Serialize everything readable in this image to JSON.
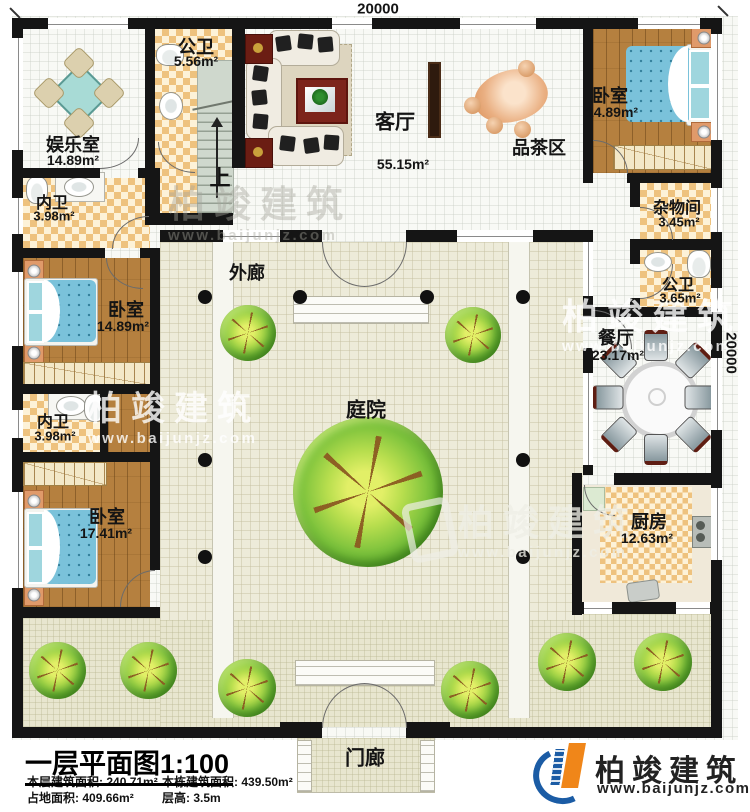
{
  "plan": {
    "dimension_top": "20000",
    "dimension_right": "20000",
    "stair_direction": "上"
  },
  "rooms": {
    "entertainment": {
      "name": "娱乐室",
      "area": "14.89m²"
    },
    "bath_top": {
      "name": "公卫",
      "area": "5.56m²"
    },
    "living": {
      "name": "客厅",
      "area": "55.15m²"
    },
    "tea_area": {
      "name": "品茶区"
    },
    "bedroom_top_right": {
      "name": "卧室",
      "area": "14.89m²"
    },
    "storage": {
      "name": "杂物间",
      "area": "3.45m²"
    },
    "bath_right": {
      "name": "公卫",
      "area": "3.65m²"
    },
    "dining": {
      "name": "餐厅",
      "area": "23.17m²"
    },
    "kitchen": {
      "name": "厨房",
      "area": "12.63m²"
    },
    "bath_inner_1": {
      "name": "内卫",
      "area": "3.98m²"
    },
    "bedroom_mid_left": {
      "name": "卧室",
      "area": "14.89m²"
    },
    "bath_inner_2": {
      "name": "内卫",
      "area": "3.98m²"
    },
    "bedroom_bottom_left": {
      "name": "卧室",
      "area": "17.41m²"
    },
    "veranda": {
      "name": "外廊"
    },
    "courtyard": {
      "name": "庭院"
    },
    "porch": {
      "name": "门廊"
    }
  },
  "title_block": {
    "title": "一层平面图",
    "scale": "1:100",
    "stats": [
      {
        "label": "本层建筑面积:",
        "value": "240.71m²"
      },
      {
        "label": "本栋建筑面积:",
        "value": "439.50m²"
      },
      {
        "label": "占地面积:",
        "value": "409.66m²"
      },
      {
        "label": "层高:",
        "value": "3.5m"
      }
    ]
  },
  "branding": {
    "watermark_text": "柏竣建筑",
    "watermark_url": "www.baijunjz.com",
    "logo_text": "柏竣建筑",
    "logo_url": "www.baijunjz.com"
  },
  "colors": {
    "wall": "#151515",
    "wood_floor": "#b5803f",
    "checker_tile": "#eec27e",
    "courtyard_floor": "#edebd9",
    "garden_floor": "#e8e6cf",
    "bed_blue": "#7ac2da",
    "logo_blue": "#1b5ca5",
    "logo_orange": "#f08619"
  }
}
